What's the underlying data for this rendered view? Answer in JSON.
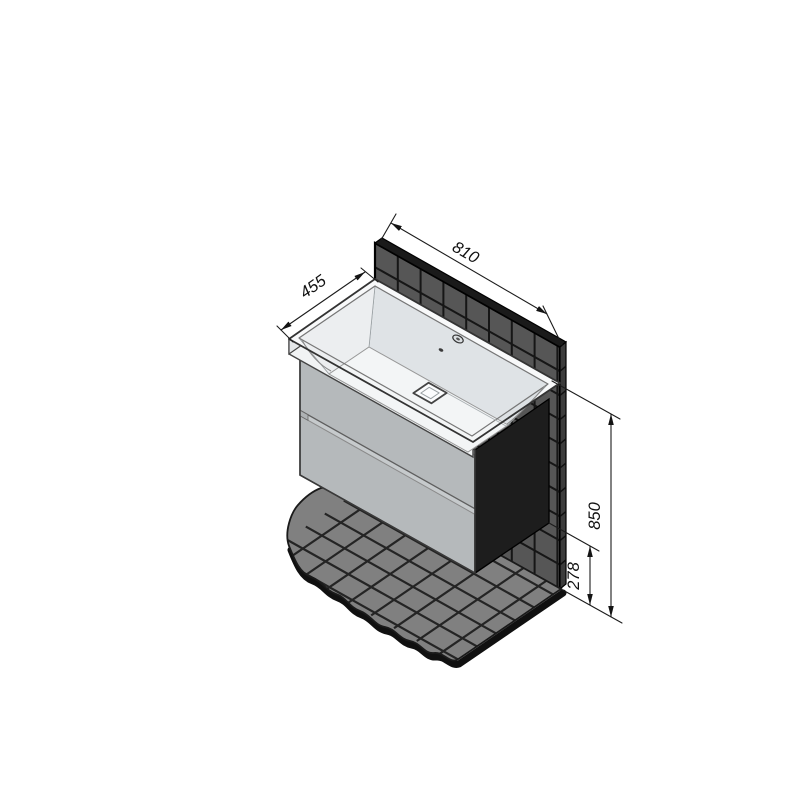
{
  "title": {
    "part1": "тумба консольная",
    "part2": "Импрэс т18-80",
    "part3": "под умывальник",
    "part4": "Грэмми"
  },
  "dimensions": {
    "width": "810",
    "depth": "455",
    "height": "850",
    "clearance": "278"
  },
  "colors": {
    "background": "#ffffff",
    "wall_tile": "#565656",
    "wall_grout": "#161616",
    "wall_top": "#1a1a1a",
    "wall_side": "#3c3c3c",
    "floor_tile": "#808080",
    "floor_grout": "#242424",
    "floor_edge": "#101010",
    "cabinet_front": "#b5b9bb",
    "cabinet_rail": "#a2a7aa",
    "cabinet_gap": "#c6cacc",
    "cabinet_side": "#1d1d1d",
    "sink_rim": "#f8f9fa",
    "sink_front_wall": "#e7eaec",
    "sink_back_wall": "#dfe3e6",
    "sink_left_wall": "#eceef0",
    "sink_right_wall": "#dde1e4",
    "sink_bottom": "#f3f5f6",
    "sink_apron": "#f1f3f4",
    "sink_left_face": "#e4e7e9",
    "dim_line": "#1c1c1c"
  }
}
